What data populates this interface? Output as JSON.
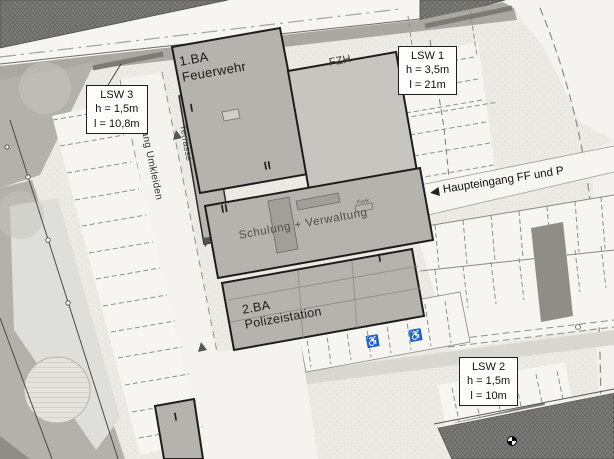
{
  "plan": {
    "buildings": {
      "feuerwehr": {
        "phase": "1.BA",
        "name": "Feuerwehr",
        "storeys": "II"
      },
      "fzh": {
        "name": "FZH"
      },
      "schulung_verwaltung": {
        "name": "Schulung + Verwaltung",
        "storeys": "II"
      },
      "polizeistation": {
        "phase": "2.BA",
        "name": "Polizeistation",
        "storeys": "I"
      },
      "terrasse_wing": {
        "name": "Terrasse",
        "storeys": "I"
      },
      "garage": {
        "storeys": "I"
      },
      "funk": {
        "name": "Funk"
      }
    },
    "noise_walls": {
      "lsw1": {
        "id": "LSW 1",
        "height": "h = 3,5m",
        "length": "l = 21m"
      },
      "lsw2": {
        "id": "LSW 2",
        "height": "h = 1,5m",
        "length": "l = 10m"
      },
      "lsw3": {
        "id": "LSW 3",
        "height": "h = 1,5m",
        "length": "l = 10,8m"
      }
    },
    "annotations": {
      "main_entrance": "Haupteingang FF und P",
      "main_entrance_arrow": "◀",
      "access_path": "Zugang Umkleiden",
      "accessible_parking_icon": "♿"
    },
    "colors": {
      "road_dark": "#7b7b78",
      "building_fill": "#b4b3ad",
      "building_outline": "#1d1d1d",
      "site_background": "#eceae5"
    }
  }
}
